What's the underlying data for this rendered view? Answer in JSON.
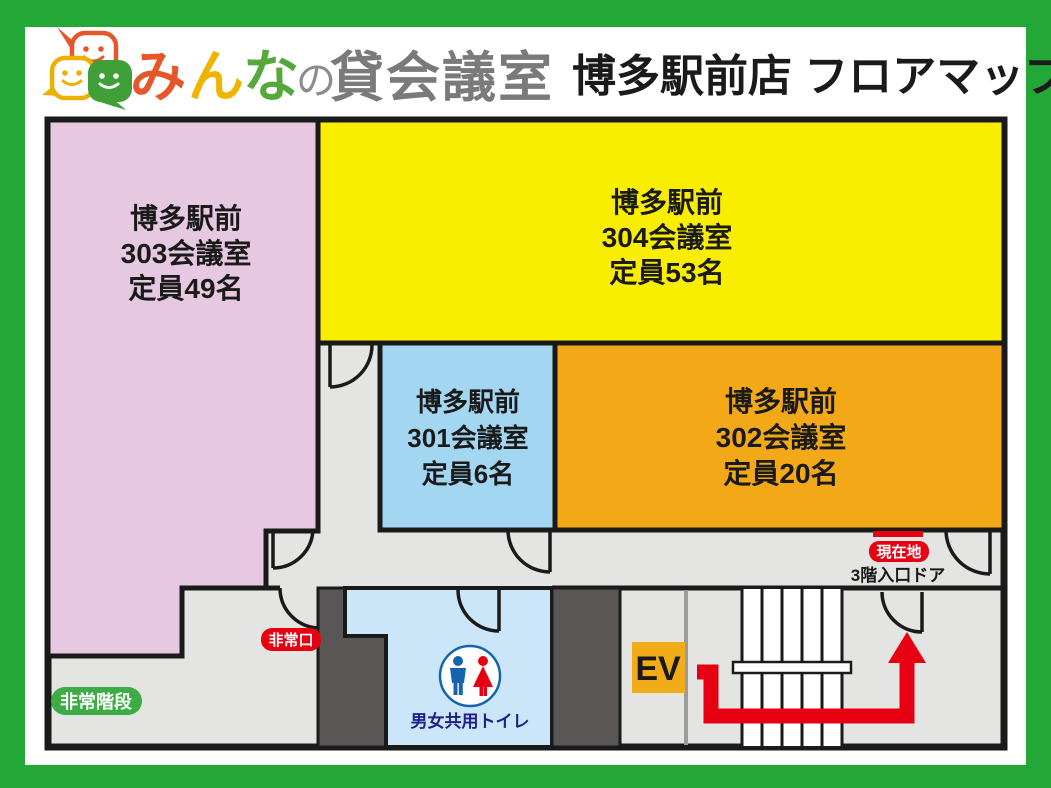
{
  "header": {
    "brand": {
      "chars": [
        {
          "ch": "み",
          "color": "#E4572A"
        },
        {
          "ch": "ん",
          "color": "#EFB400"
        },
        {
          "ch": "な",
          "color": "#55A93C"
        }
      ],
      "particle": "の",
      "suffix": "貸会議室"
    },
    "store_title": "博多駅前店 フロアマップ"
  },
  "rooms": {
    "r303": {
      "fill": "#E6C8E1",
      "lines": [
        "博多駅前",
        "303会議室",
        "定員49名"
      ]
    },
    "r304": {
      "fill": "#FAEE00",
      "lines": [
        "博多駅前",
        "304会議室",
        "定員53名"
      ]
    },
    "r301": {
      "fill": "#A3D6F0",
      "lines": [
        "博多駅前",
        "301会議室",
        "定員6名"
      ]
    },
    "r302": {
      "fill": "#F2A817",
      "lines": [
        "博多駅前",
        "302会議室",
        "定員20名"
      ]
    }
  },
  "labels": {
    "current_location": "現在地",
    "entrance_door": "3階入口ドア",
    "emergency_exit": "非常口",
    "emergency_stairs": "非常階段",
    "toilet": "男女共用トイレ",
    "elevator": "EV"
  },
  "colors": {
    "frame_green": "#23A838",
    "accent_red": "#E60012",
    "badge_green": "#3CAC44",
    "wall_dark": "#5A5656",
    "floor_gray": "#E4E4E3",
    "toilet_blue": "#CBE6F8",
    "ev_orange": "#F2AC19"
  }
}
